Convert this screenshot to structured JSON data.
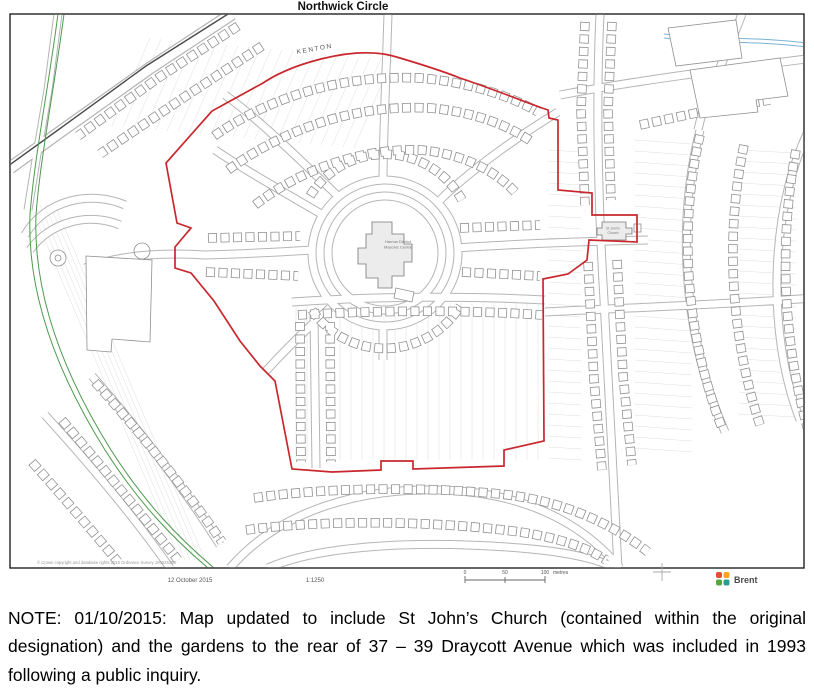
{
  "map": {
    "title": "Northwick Circle",
    "area_label": "KENTON",
    "center_label_line1": "Harrow District",
    "center_label_line2": "Masonic Centre",
    "church_label_line1": "St John's",
    "church_label_line2": "Church",
    "copyright": "© Crown copyright and database rights 2015 Ordnance Survey 100025260",
    "boundary_color": "#c8272d",
    "footer": {
      "date": "12 October 2015",
      "scale": "1:1250",
      "scalebar_start": "0",
      "scalebar_mid": "50",
      "scalebar_end": "100",
      "scalebar_unit": "metres",
      "logo_text": "Brent",
      "logo_colors": [
        "#e74c3c",
        "#f5a623",
        "#57a639",
        "#2a9d8f"
      ]
    }
  },
  "note": {
    "text": "NOTE: 01/10/2015: Map updated to include St John’s Church (contained within the original designation) and the gardens to the rear of 37 – 39 Draycott Avenue which was included in 1993 following a public inquiry."
  }
}
